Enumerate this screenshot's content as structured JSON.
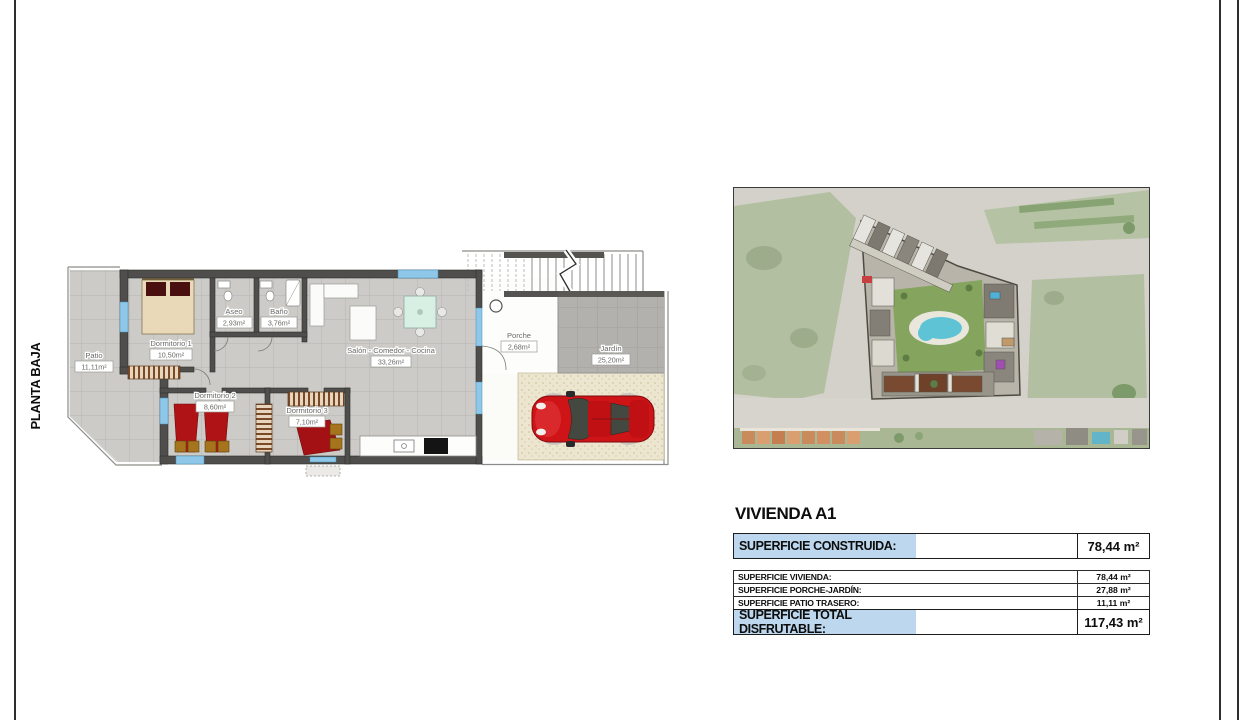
{
  "sheet": {
    "plan_label": "PLANTA BAJA"
  },
  "floor_plan": {
    "rooms": [
      {
        "name": "Patio",
        "area": "11,11m²"
      },
      {
        "name": "Dormitorio 1",
        "area": "10,50m²"
      },
      {
        "name": "Aseo",
        "area": "2,93m²"
      },
      {
        "name": "Baño",
        "area": "3,76m²"
      },
      {
        "name": "Dormitorio 2",
        "area": "8,60m²"
      },
      {
        "name": "Dormitorio 3",
        "area": "7,10m²"
      },
      {
        "name": "Salón - Comedor - Cocina",
        "area": "33,26m²"
      },
      {
        "name": "Porche",
        "area": "2,68m²"
      },
      {
        "name": "Jardín",
        "area": "25,20m²"
      }
    ]
  },
  "summary": {
    "title": "VIVIENDA A1",
    "highlight_color": "#bdd7ee",
    "construida": {
      "label": "SUPERFICIE CONSTRUIDA:",
      "value": "78,44 m²"
    },
    "rows": [
      {
        "label": "SUPERFICIE VIVIENDA:",
        "value": "78,44 m²"
      },
      {
        "label": "SUPERFICIE PORCHE-JARDÍN:",
        "value": "27,88 m²"
      },
      {
        "label": "SUPERFICIE PATIO TRASERO:",
        "value": "11,11 m²"
      }
    ],
    "total": {
      "label": "SUPERFICIE TOTAL DISFRUTABLE:",
      "value": "117,43 m²"
    }
  }
}
